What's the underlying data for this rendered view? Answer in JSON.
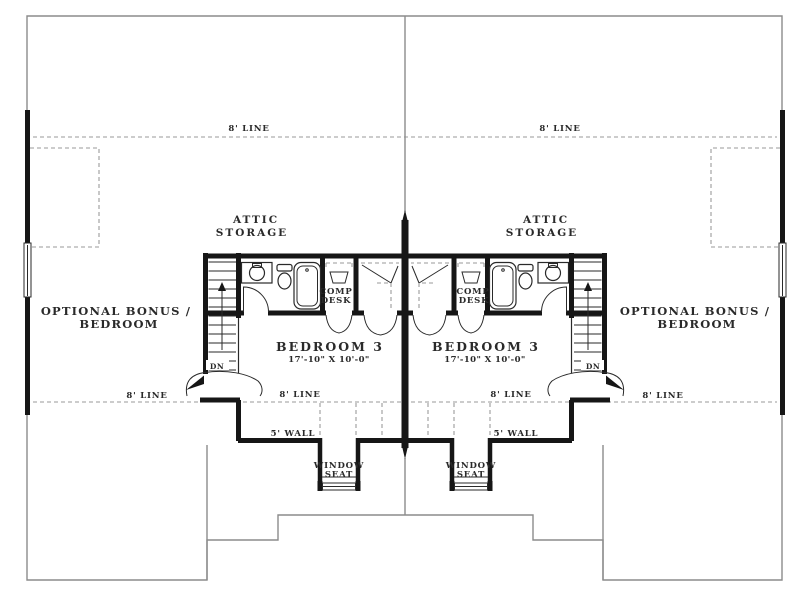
{
  "labels": {
    "eight_line": "8' LINE",
    "attic_1": "ATTIC",
    "attic_2": "STORAGE",
    "bonus_1": "OPTIONAL BONUS /",
    "bonus_2": "BEDROOM",
    "bedroom3": "BEDROOM 3",
    "bedroom3_dims": "17'-10\" X 10'-0\"",
    "comp_1": "COMP",
    "comp_2": "DESK",
    "dn": "DN",
    "five_wall": "5' WALL",
    "window_seat_1": "WINDOW",
    "window_seat_2": "SEAT"
  },
  "colors": {
    "wall": "#161616",
    "ink": "#2a2a2a",
    "outline": "#8c8c8c",
    "dashed": "#9a9a9a",
    "bg": "#ffffff"
  }
}
